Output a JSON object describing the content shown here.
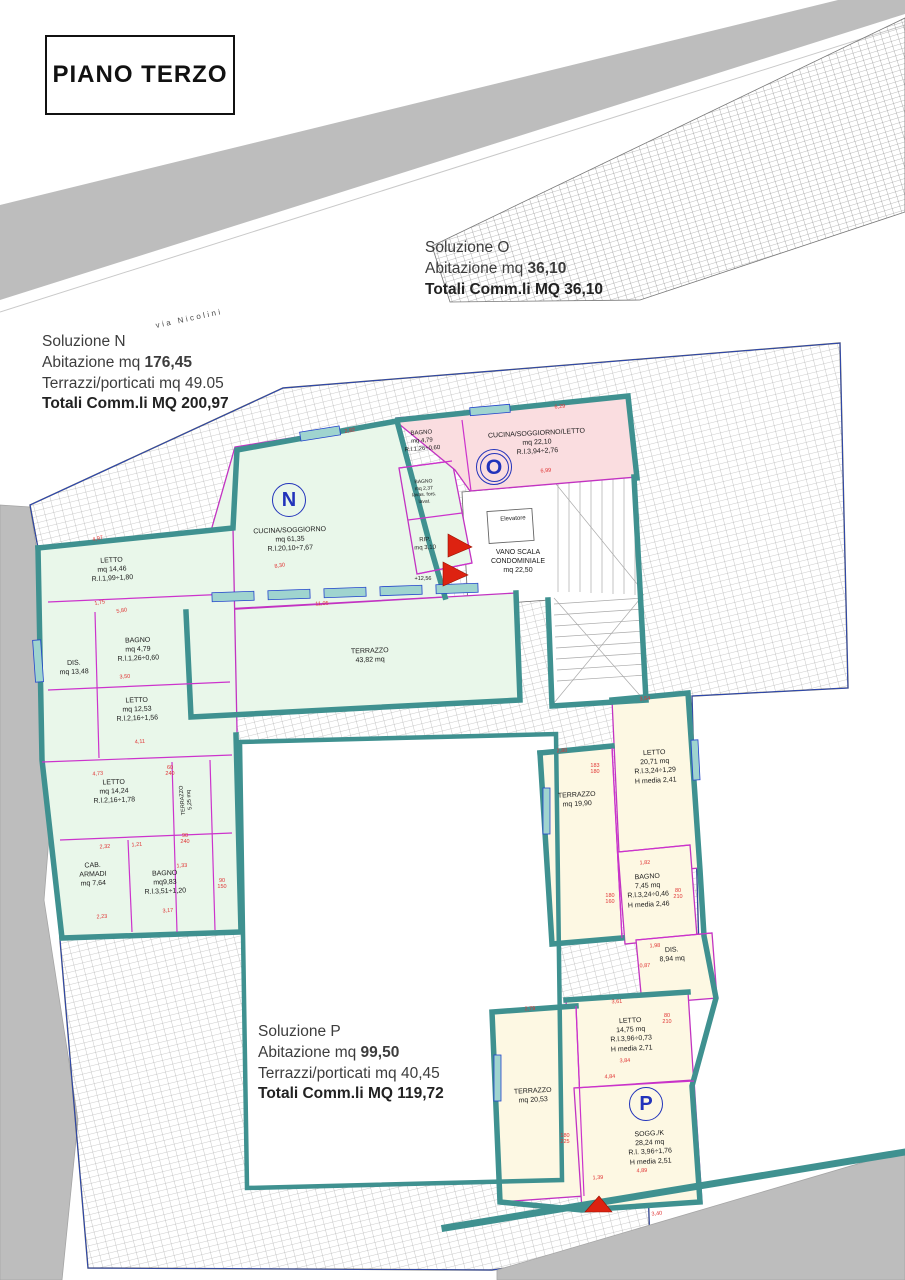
{
  "title": "PIANO TERZO",
  "street_label": "via Nicolini",
  "solutions": [
    {
      "id": "N",
      "x": 42,
      "y": 332,
      "lines": [
        [
          {
            "t": "Soluzione N"
          }
        ],
        [
          {
            "t": "Abitazione mq "
          },
          {
            "t": "176,45",
            "b": true
          }
        ],
        [
          {
            "t": "Terrazzi/porticati mq 49.05"
          }
        ],
        [
          {
            "t": "Totali Comm.li MQ 200,97",
            "b": true
          }
        ]
      ]
    },
    {
      "id": "O",
      "x": 425,
      "y": 238,
      "lines": [
        [
          {
            "t": "Soluzione O"
          }
        ],
        [
          {
            "t": "Abitazione mq "
          },
          {
            "t": "36,10",
            "b": true
          }
        ],
        [
          {
            "t": "Totali Comm.li MQ 36,10",
            "b": true
          }
        ]
      ]
    },
    {
      "id": "P",
      "x": 258,
      "y": 1022,
      "lines": [
        [
          {
            "t": "Soluzione P"
          }
        ],
        [
          {
            "t": "Abitazione mq "
          },
          {
            "t": "99,50",
            "b": true
          }
        ],
        [
          {
            "t": "Terrazzi/porticati mq 40,45"
          }
        ],
        [
          {
            "t": "Totali Comm.li MQ 119,72",
            "b": true
          }
        ]
      ]
    }
  ],
  "unit_markers": [
    {
      "label": "N",
      "x": 289,
      "y": 500,
      "r": 16,
      "double": false
    },
    {
      "label": "O",
      "x": 494,
      "y": 467,
      "r": 17,
      "double": true
    },
    {
      "label": "P",
      "x": 646,
      "y": 1104,
      "r": 16,
      "double": false
    }
  ],
  "rooms": [
    {
      "id": "cucina-soggiorno-n",
      "x": 290,
      "y": 540,
      "rot": -2,
      "text": "CUCINA/SOGGIORNO\nmq 61,35\nR.l.20,10÷7,67"
    },
    {
      "id": "letto-1446",
      "x": 112,
      "y": 570,
      "rot": -3,
      "text": "LETTO\nmq 14,46\nR.l.1,99÷1,80"
    },
    {
      "id": "bagno-479-n",
      "x": 138,
      "y": 650,
      "rot": -2,
      "text": "BAGNO\nmq 4,79\nR.l.1,26÷0,60"
    },
    {
      "id": "dis-1348",
      "x": 74,
      "y": 668,
      "rot": -2,
      "text": "DIS.\nmq 13,48"
    },
    {
      "id": "letto-1253",
      "x": 137,
      "y": 710,
      "rot": -2,
      "text": "LETTO\nmq 12,53\nR.l.2,16÷1,56"
    },
    {
      "id": "letto-1424",
      "x": 114,
      "y": 792,
      "rot": -2,
      "text": "LETTO\nmq 14,24\nR.l.2,16÷1,78"
    },
    {
      "id": "terrazzo-525",
      "x": 187,
      "y": 800,
      "rot": -95,
      "size": 5.5,
      "text": "TERRAZZO\n5,25 mq"
    },
    {
      "id": "cab-armadi",
      "x": 93,
      "y": 875,
      "rot": -2,
      "text": "CAB.\nARMADI\nmq 7,64"
    },
    {
      "id": "bagno-983",
      "x": 165,
      "y": 883,
      "rot": -2,
      "text": "BAGNO\nmq9,83\nR.l.3,51÷1,20"
    },
    {
      "id": "bagno-237",
      "x": 424,
      "y": 492,
      "rot": -3,
      "size": 5,
      "text": "BAGNO\nmq 2,37\nlavas. fors.\nlavat."
    },
    {
      "id": "rip-310",
      "x": 425,
      "y": 545,
      "rot": -3,
      "size": 6,
      "text": "RIP.\nmq 3,10"
    },
    {
      "id": "terrazzo-4382",
      "x": 370,
      "y": 656,
      "rot": -2,
      "text": "TERRAZZO\n43,82 mq"
    },
    {
      "id": "bagno-479-o",
      "x": 422,
      "y": 442,
      "rot": -4,
      "size": 6,
      "text": "BAGNO\nmq 4,79\nR.l.1,26÷0,60"
    },
    {
      "id": "cucina-soggiorno-letto-o",
      "x": 537,
      "y": 443,
      "rot": -3,
      "text": "CUCINA/SOGGIORNO/LETTO\nmq 22,10\nR.l.3,94÷2,76"
    },
    {
      "id": "elevatore",
      "x": 513,
      "y": 520,
      "rot": -3,
      "size": 6,
      "text": "Elevatore"
    },
    {
      "id": "vano-scala",
      "x": 518,
      "y": 562,
      "rot": 0,
      "text": "VANO SCALA\nCONDOMINIALE\nmq 22,50"
    },
    {
      "id": "terrazzo-1990",
      "x": 577,
      "y": 800,
      "rot": -3,
      "text": "TERRAZZO\nmq 19,90"
    },
    {
      "id": "letto-2071",
      "x": 655,
      "y": 767,
      "rot": -3,
      "text": "LETTO\n20,71 mq\nR.l.3,24÷1,29\nH media 2,41"
    },
    {
      "id": "bagno-745",
      "x": 648,
      "y": 891,
      "rot": -3,
      "text": "BAGNO\n7,45 mq\nR.l.3,24÷0,46\nH media 2,46"
    },
    {
      "id": "dis-894",
      "x": 672,
      "y": 955,
      "rot": -3,
      "text": "DIS.\n8,94 mq"
    },
    {
      "id": "letto-1475",
      "x": 631,
      "y": 1035,
      "rot": -3,
      "text": "LETTO\n14,75 mq\nR.l.3,96÷0,73\nH media 2,71"
    },
    {
      "id": "terrazzo-2053",
      "x": 533,
      "y": 1096,
      "rot": -3,
      "text": "TERRAZZO\nmq 20,53"
    },
    {
      "id": "sogg-k",
      "x": 650,
      "y": 1148,
      "rot": -3,
      "text": "SOGG./K\n28,24 mq\nR.l. 3,96÷1,76\nH media 2,51"
    }
  ],
  "dimensions": [
    {
      "t": "6,29",
      "x": 560,
      "y": 408,
      "r": -5
    },
    {
      "t": "2,92",
      "x": 350,
      "y": 432,
      "r": -10
    },
    {
      "t": "6,99",
      "x": 546,
      "y": 472,
      "r": -5
    },
    {
      "t": "4,97",
      "x": 98,
      "y": 540,
      "r": -12
    },
    {
      "t": "1,75",
      "x": 100,
      "y": 604,
      "r": -10
    },
    {
      "t": "5,80",
      "x": 122,
      "y": 612,
      "r": -10
    },
    {
      "t": "8,30",
      "x": 280,
      "y": 567,
      "r": -10
    },
    {
      "t": "11,05",
      "x": 322,
      "y": 605,
      "r": -3
    },
    {
      "t": "3,50",
      "x": 125,
      "y": 678,
      "r": -4
    },
    {
      "t": "4,11",
      "x": 140,
      "y": 743,
      "r": -4
    },
    {
      "t": "4,73",
      "x": 98,
      "y": 775,
      "r": -6
    },
    {
      "t": "2,32",
      "x": 105,
      "y": 848,
      "r": -4
    },
    {
      "t": "1,21",
      "x": 137,
      "y": 846,
      "r": -4
    },
    {
      "t": "2,23",
      "x": 102,
      "y": 918,
      "r": -4
    },
    {
      "t": "3,17",
      "x": 168,
      "y": 912,
      "r": -4
    },
    {
      "t": "1,33",
      "x": 182,
      "y": 867,
      "r": -4
    },
    {
      "t": "60\n240",
      "x": 170,
      "y": 772,
      "r": 0
    },
    {
      "t": "90\n240",
      "x": 185,
      "y": 840,
      "r": 0
    },
    {
      "t": "90\n150",
      "x": 222,
      "y": 885,
      "r": 0
    },
    {
      "t": "+12,56",
      "x": 423,
      "y": 580,
      "r": 0,
      "c": "#222"
    },
    {
      "t": "3,54",
      "x": 645,
      "y": 700,
      "r": -4
    },
    {
      "t": "2,80",
      "x": 562,
      "y": 752,
      "r": -3
    },
    {
      "t": "183\n180",
      "x": 595,
      "y": 770,
      "r": 0
    },
    {
      "t": "1,82",
      "x": 645,
      "y": 864,
      "r": -3
    },
    {
      "t": "180\n160",
      "x": 610,
      "y": 900,
      "r": 0
    },
    {
      "t": "80\n210",
      "x": 678,
      "y": 895,
      "r": 0
    },
    {
      "t": "1,98",
      "x": 655,
      "y": 947,
      "r": -3
    },
    {
      "t": "0,87",
      "x": 645,
      "y": 967,
      "r": -3
    },
    {
      "t": "3,61",
      "x": 617,
      "y": 1003,
      "r": -3
    },
    {
      "t": "80\n210",
      "x": 667,
      "y": 1020,
      "r": 0
    },
    {
      "t": "3,84",
      "x": 625,
      "y": 1062,
      "r": -3
    },
    {
      "t": "4,84",
      "x": 610,
      "y": 1078,
      "r": -3
    },
    {
      "t": "2,79",
      "x": 530,
      "y": 1010,
      "r": -3
    },
    {
      "t": "180\n225",
      "x": 565,
      "y": 1140,
      "r": 0
    },
    {
      "t": "4,89",
      "x": 642,
      "y": 1172,
      "r": -3
    },
    {
      "t": "3,40",
      "x": 657,
      "y": 1215,
      "r": -6
    },
    {
      "t": "1,39",
      "x": 598,
      "y": 1179,
      "r": -3
    }
  ],
  "colors": {
    "unit_n_fill": "#e9f7ea",
    "unit_o_fill": "#fadde0",
    "unit_p_fill": "#fdf8e3",
    "wall": "#3f9190",
    "partition": "#cc33cc",
    "property_line": "#2244cc",
    "dimension_text": "#e03333",
    "road": "#bdbdbd",
    "marker": "#2233bb",
    "stair_arrow": "#dd2211"
  }
}
